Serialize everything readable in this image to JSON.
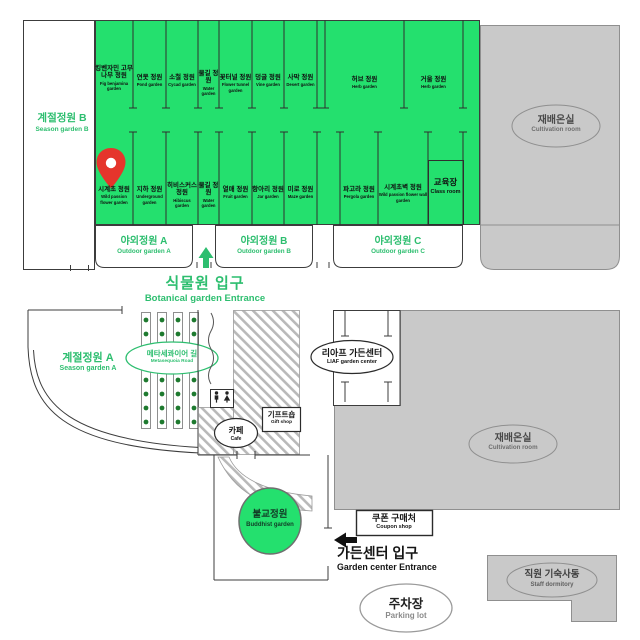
{
  "colors": {
    "map_green": "#24E06E",
    "accent_green_text": "#2DBE6F",
    "building_gray": "#C9C9C9",
    "building_border": "#8F8F8F",
    "wall": "#3C3C3C",
    "tree_dot_green": "#1E7A2F",
    "pin_red": "#E5352C",
    "hatch_gray": "#B9B9B9",
    "black_text": "#141414"
  },
  "top_block": {
    "season_garden_b": {
      "ko": "계절정원 B",
      "en": "Season garden B"
    },
    "cultivation_room_top": {
      "ko": "재배온실",
      "en": "Cultivation room"
    },
    "row1": [
      {
        "ko": "킹벤자민 고무나무 정원",
        "en": "Fig benjamina garden"
      },
      {
        "ko": "연못 정원",
        "en": "Pond garden"
      },
      {
        "ko": "소철 정원",
        "en": "Cycad garden"
      },
      {
        "ko": "물길 정원",
        "en": "Water garden"
      },
      {
        "ko": "꽃터널 정원",
        "en": "Flower tunnel garden"
      },
      {
        "ko": "덩굴 정원",
        "en": "Vine garden"
      },
      {
        "ko": "사막 정원",
        "en": "Desert garden"
      },
      {
        "ko": "허브 정원",
        "en": "Herb garden"
      },
      {
        "ko": "거울 정원",
        "en": "Herb garden"
      }
    ],
    "row2": [
      {
        "ko": "시계초 정원",
        "en": "Wild passion flower garden"
      },
      {
        "ko": "지하 정원",
        "en": "Underground garden"
      },
      {
        "ko": "히비스커스 정원",
        "en": "Hibiscus garden"
      },
      {
        "ko": "물길 정원",
        "en": "Water garden"
      },
      {
        "ko": "열매 정원",
        "en": "Fruit garden"
      },
      {
        "ko": "항아리 정원",
        "en": "Jar garden"
      },
      {
        "ko": "미로 정원",
        "en": "Maze garden"
      },
      {
        "ko": "파고라 정원",
        "en": "Pergola garden"
      },
      {
        "ko": "시계초벽 정원",
        "en": "Wild passion flower wall garden"
      },
      {
        "ko": "교육장",
        "en": "Class room"
      }
    ],
    "outdoor_gardens": [
      {
        "ko": "야외정원 A",
        "en": "Outdoor garden A"
      },
      {
        "ko": "야외정원 B",
        "en": "Outdoor garden B"
      },
      {
        "ko": "야외정원 C",
        "en": "Outdoor garden C"
      }
    ]
  },
  "entrance": {
    "ko": "식물원 입구",
    "en": "Botanical garden Entrance"
  },
  "middle_block": {
    "season_garden_a": {
      "ko": "계절정원 A",
      "en": "Season garden A"
    },
    "metasequoia_road": {
      "ko": "메타세콰이어 길",
      "en": "Metasequoia Road"
    },
    "liaf_garden_center": {
      "ko": "리아프 가든센터",
      "en": "LIAF garden center"
    },
    "cafe": {
      "ko": "카페",
      "en": "Cafe"
    },
    "gift_shop": {
      "ko": "기프트숍",
      "en": "Gift shop"
    },
    "cultivation_room_mid": {
      "ko": "재배온실",
      "en": "Cultivation room"
    },
    "buddhist_garden": {
      "ko": "불교정원",
      "en": "Buddhist garden"
    },
    "coupon_shop": {
      "ko": "쿠폰 구매처",
      "en": "Coupon shop"
    }
  },
  "bottom": {
    "garden_center_entrance": {
      "ko": "가든센터 입구",
      "en": "Garden center Entrance"
    },
    "parking_lot": {
      "ko": "주차장",
      "en": "Parking lot"
    },
    "staff_dormitory": {
      "ko": "직원 기숙사동",
      "en": "Staff dormitory"
    }
  },
  "icons": {
    "map_pin": "location-pin",
    "entrance_arrow": "arrow-up",
    "garden_center_arrow": "arrow-left",
    "restroom": "restroom-male-female"
  }
}
